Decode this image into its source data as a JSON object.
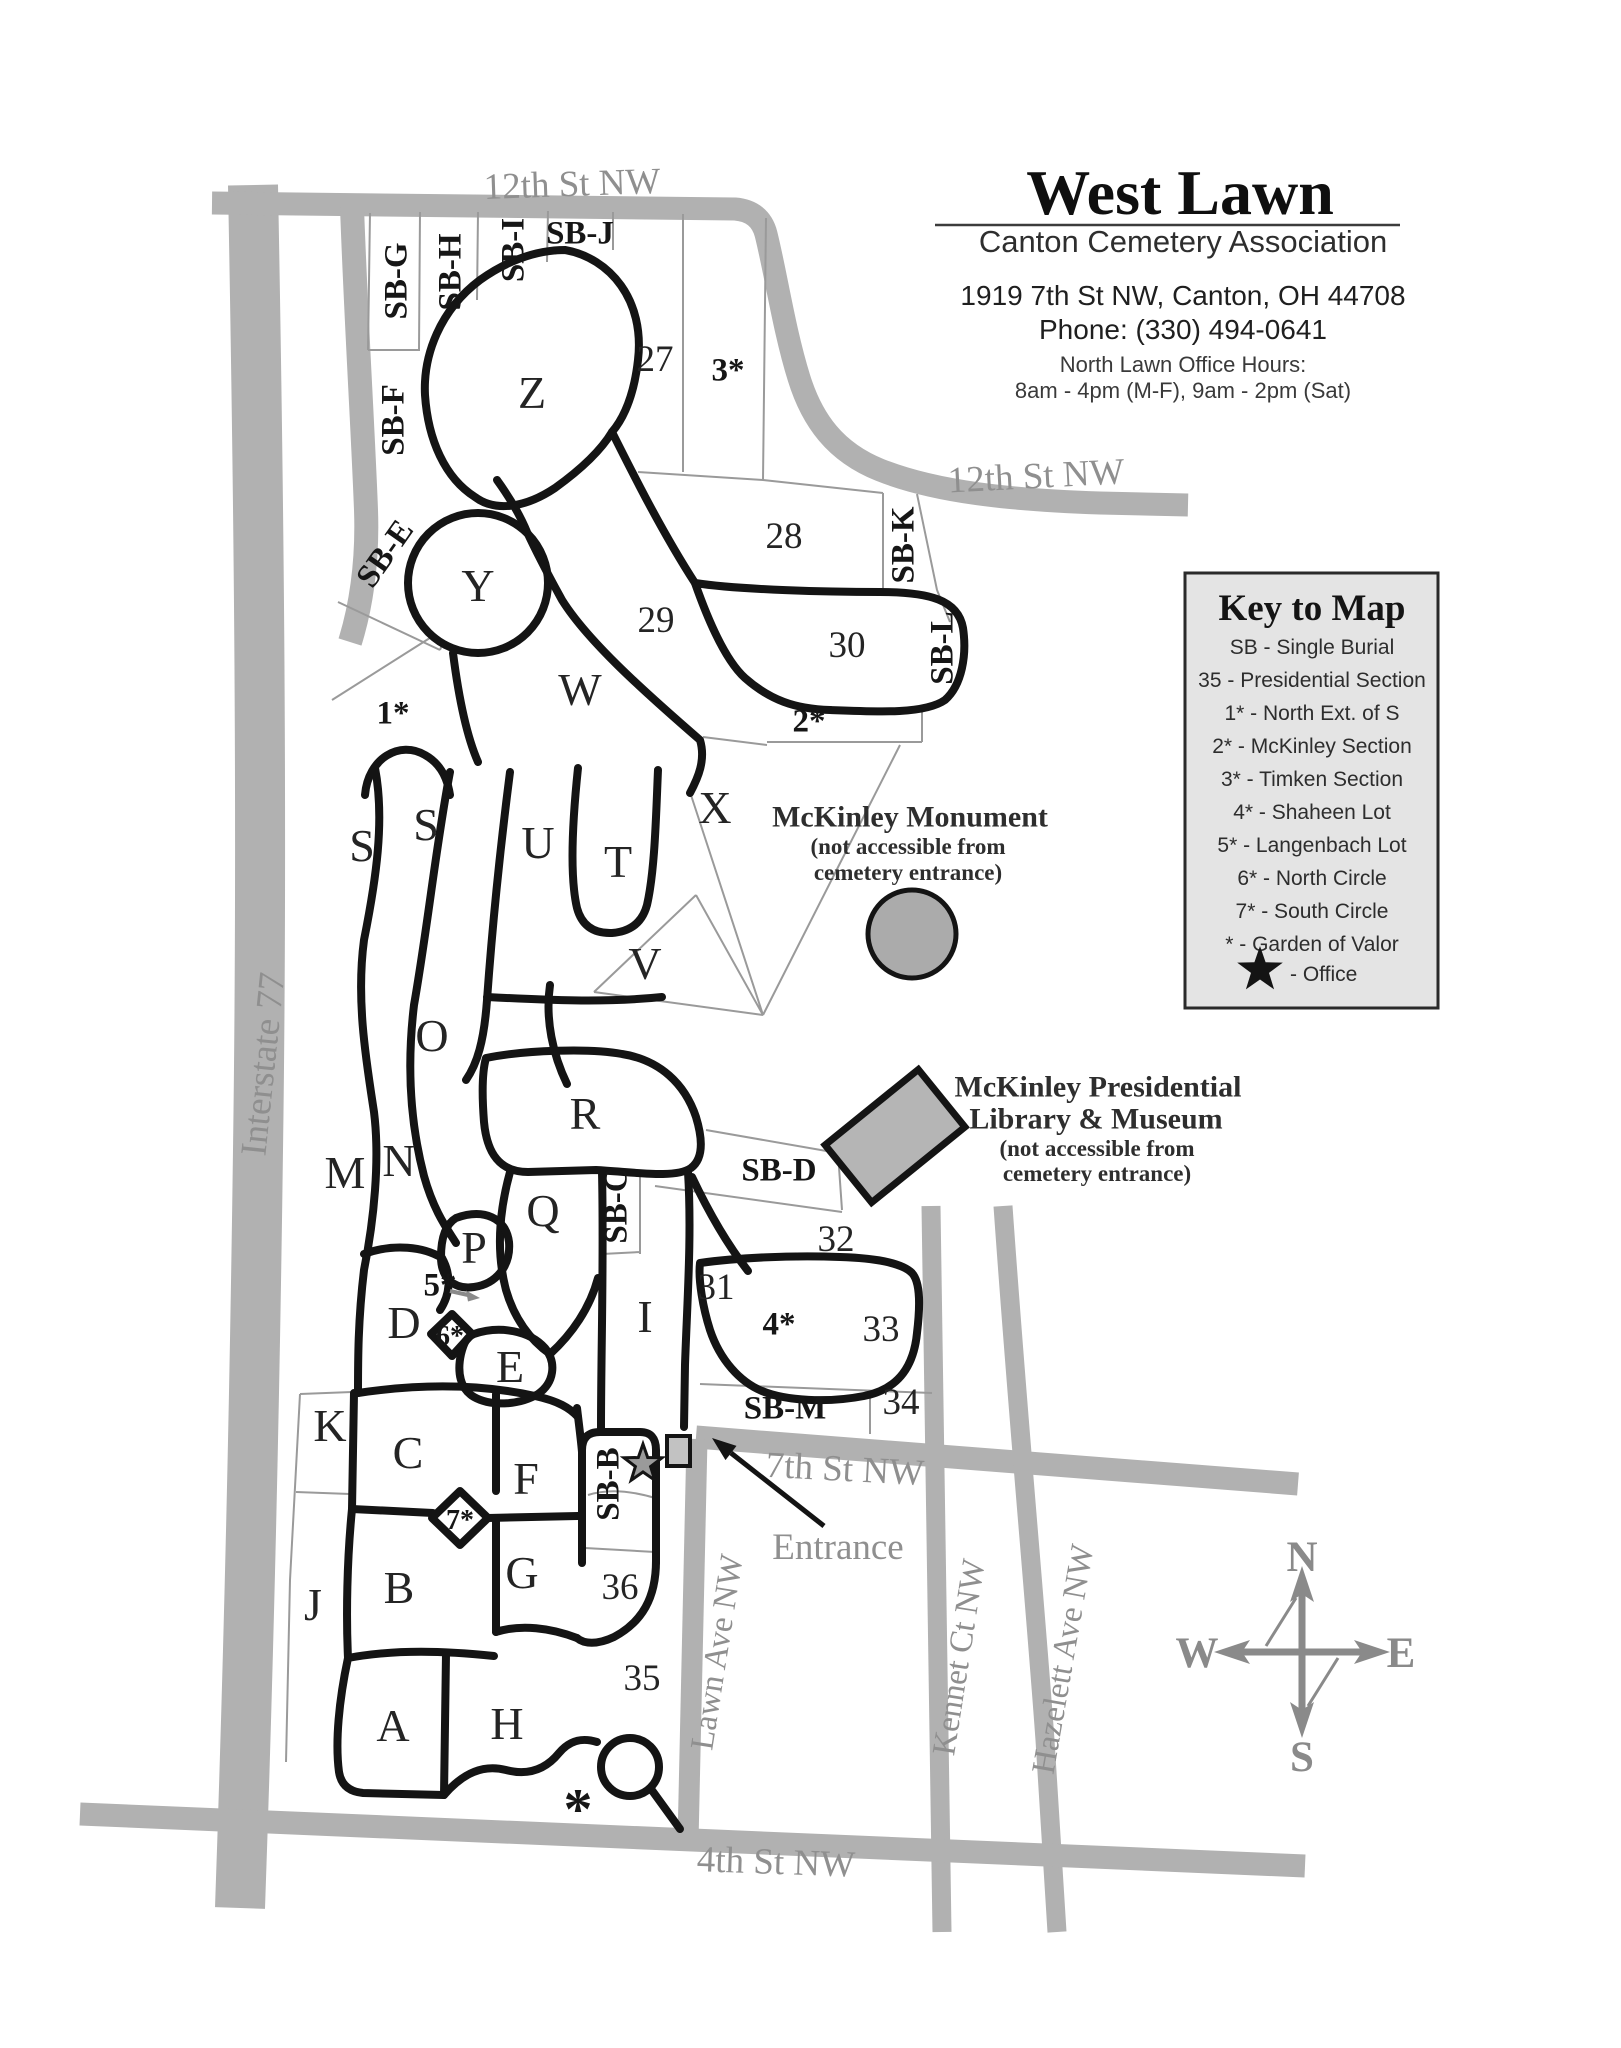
{
  "header": {
    "title": "West Lawn",
    "org": "Canton Cemetery Association",
    "address": "1919 7th St NW, Canton, OH 44708",
    "phone": "Phone: (330) 494-0641",
    "hours_label": "North Lawn Office Hours:",
    "hours": "8am - 4pm (M-F), 9am - 2pm (Sat)"
  },
  "legend": {
    "title": "Key to Map",
    "entries": [
      "SB - Single Burial",
      "35 - Presidential Section",
      "1* - North Ext. of S",
      "2* - McKinley Section",
      "3* - Timken Section",
      "4* - Shaheen Lot",
      "5* - Langenbach Lot",
      "6* - North Circle",
      "7* - South Circle",
      "* - Garden of Valor"
    ],
    "office": "- Office"
  },
  "map": {
    "streets": {
      "twelfth": "12th St NW",
      "seventh": "7th St NW",
      "fourth": "4th St NW",
      "lawn": "Lawn Ave NW",
      "kennet": "Kennet Ct NW",
      "hazelett": "Hazelett Ave NW",
      "interstate": "Interstate 77",
      "entrance": "Entrance"
    },
    "sections": {
      "a": "A",
      "b": "B",
      "c": "C",
      "d": "D",
      "e": "E",
      "f": "F",
      "g": "G",
      "h": "H",
      "i": "I",
      "j": "J",
      "k": "K",
      "m": "M",
      "n": "N",
      "o": "O",
      "p": "P",
      "q": "Q",
      "r": "R",
      "s": "S",
      "t": "T",
      "u": "U",
      "v": "V",
      "w": "W",
      "x": "X",
      "y": "Y",
      "z": "Z"
    },
    "numbers": {
      "n27": "27",
      "n28": "28",
      "n29": "29",
      "n30": "30",
      "n31": "31",
      "n32": "32",
      "n33": "33",
      "n34": "34",
      "n35": "35",
      "n36": "36"
    },
    "sb": {
      "b": "SB-B",
      "c": "SB-C",
      "d": "SB-D",
      "e": "SB-E",
      "f": "SB-F",
      "g": "SB-G",
      "h": "SB-H",
      "i": "SB-I",
      "j": "SB-J",
      "k": "SB-K",
      "l": "SB-L",
      "m": "SB-M"
    },
    "special": {
      "s1": "1*",
      "s2": "2*",
      "s3": "3*",
      "s4": "4*",
      "s5": "5*",
      "s6": "6*",
      "s7": "7*",
      "star": "*"
    },
    "landmarks": {
      "monument": "McKinley Monument",
      "museum1": "McKinley Presidential",
      "museum2": "Library & Museum",
      "note1": "(not accessible from",
      "note2": "cemetery entrance)"
    },
    "compass": {
      "n": "N",
      "e": "E",
      "s": "S",
      "w": "W"
    }
  },
  "colors": {
    "road": "#b1b1b1",
    "outline": "#141414",
    "thin_boundary": "#9a9a9a",
    "legend_bg": "#e4e4e4",
    "landmark_fill": "#ababab",
    "street_label": "#8f8f8f"
  }
}
